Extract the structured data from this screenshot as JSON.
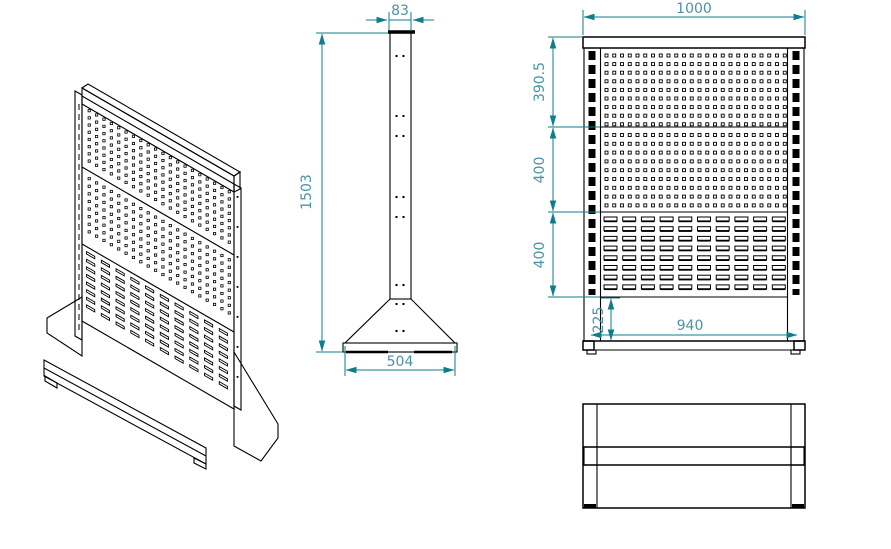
{
  "colors": {
    "background": "#ffffff",
    "geometry_line": "#000000",
    "dimension_line": "#0f7d8c",
    "dimension_text": "#4b93a4"
  },
  "dims": {
    "side_top_width": "83",
    "side_height": "1503",
    "side_base_width": "504",
    "front_overall_width": "1000",
    "front_top_panel_height": "390.5",
    "front_middle_panel_height": "400",
    "front_bottom_panel_height": "400",
    "front_base_height": "225",
    "front_base_inner_width": "940"
  }
}
